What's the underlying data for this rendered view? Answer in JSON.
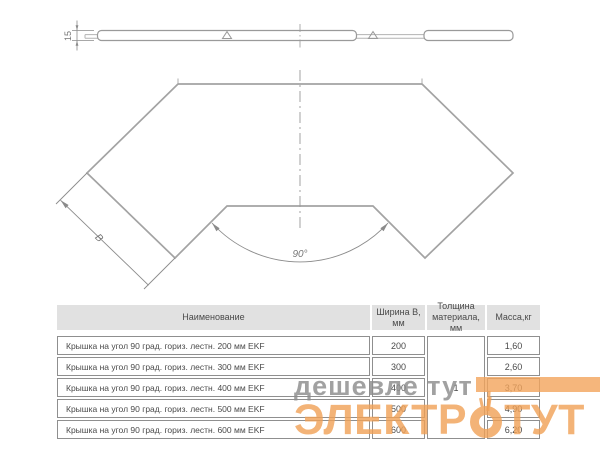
{
  "drawing": {
    "side_view": {
      "height_dim": "15"
    },
    "plan_view": {
      "width_dim": "B",
      "angle_dim": "90°"
    }
  },
  "watermark": {
    "tagline": "дешевле тут",
    "brand_left": "ЭЛЕКТР",
    "brand_right": "ТУТ",
    "accent_color": "#f1a156",
    "gray_color": "#8d8d8d"
  },
  "table": {
    "headers": {
      "name": "Наименование",
      "width": "Ширина B,\nмм",
      "thickness": "Толщина\nматериала, мм",
      "mass": "Масса,кг"
    },
    "thickness_value": "1",
    "rows": [
      {
        "name": "Крышка на угол 90 град. гориз. лестн. 200 мм EKF",
        "width": "200",
        "mass": "1,60"
      },
      {
        "name": "Крышка на угол 90 град. гориз. лестн. 300 мм EKF",
        "width": "300",
        "mass": "2,60"
      },
      {
        "name": "Крышка на угол 90 град. гориз. лестн. 400 мм EKF",
        "width": "400",
        "mass": "3,70"
      },
      {
        "name": "Крышка на угол 90 град. гориз. лестн. 500 мм EKF",
        "width": "500",
        "mass": "4,90"
      },
      {
        "name": "Крышка на угол 90 град. гориз. лестн. 600 мм EKF",
        "width": "600",
        "mass": "6,20"
      }
    ]
  }
}
